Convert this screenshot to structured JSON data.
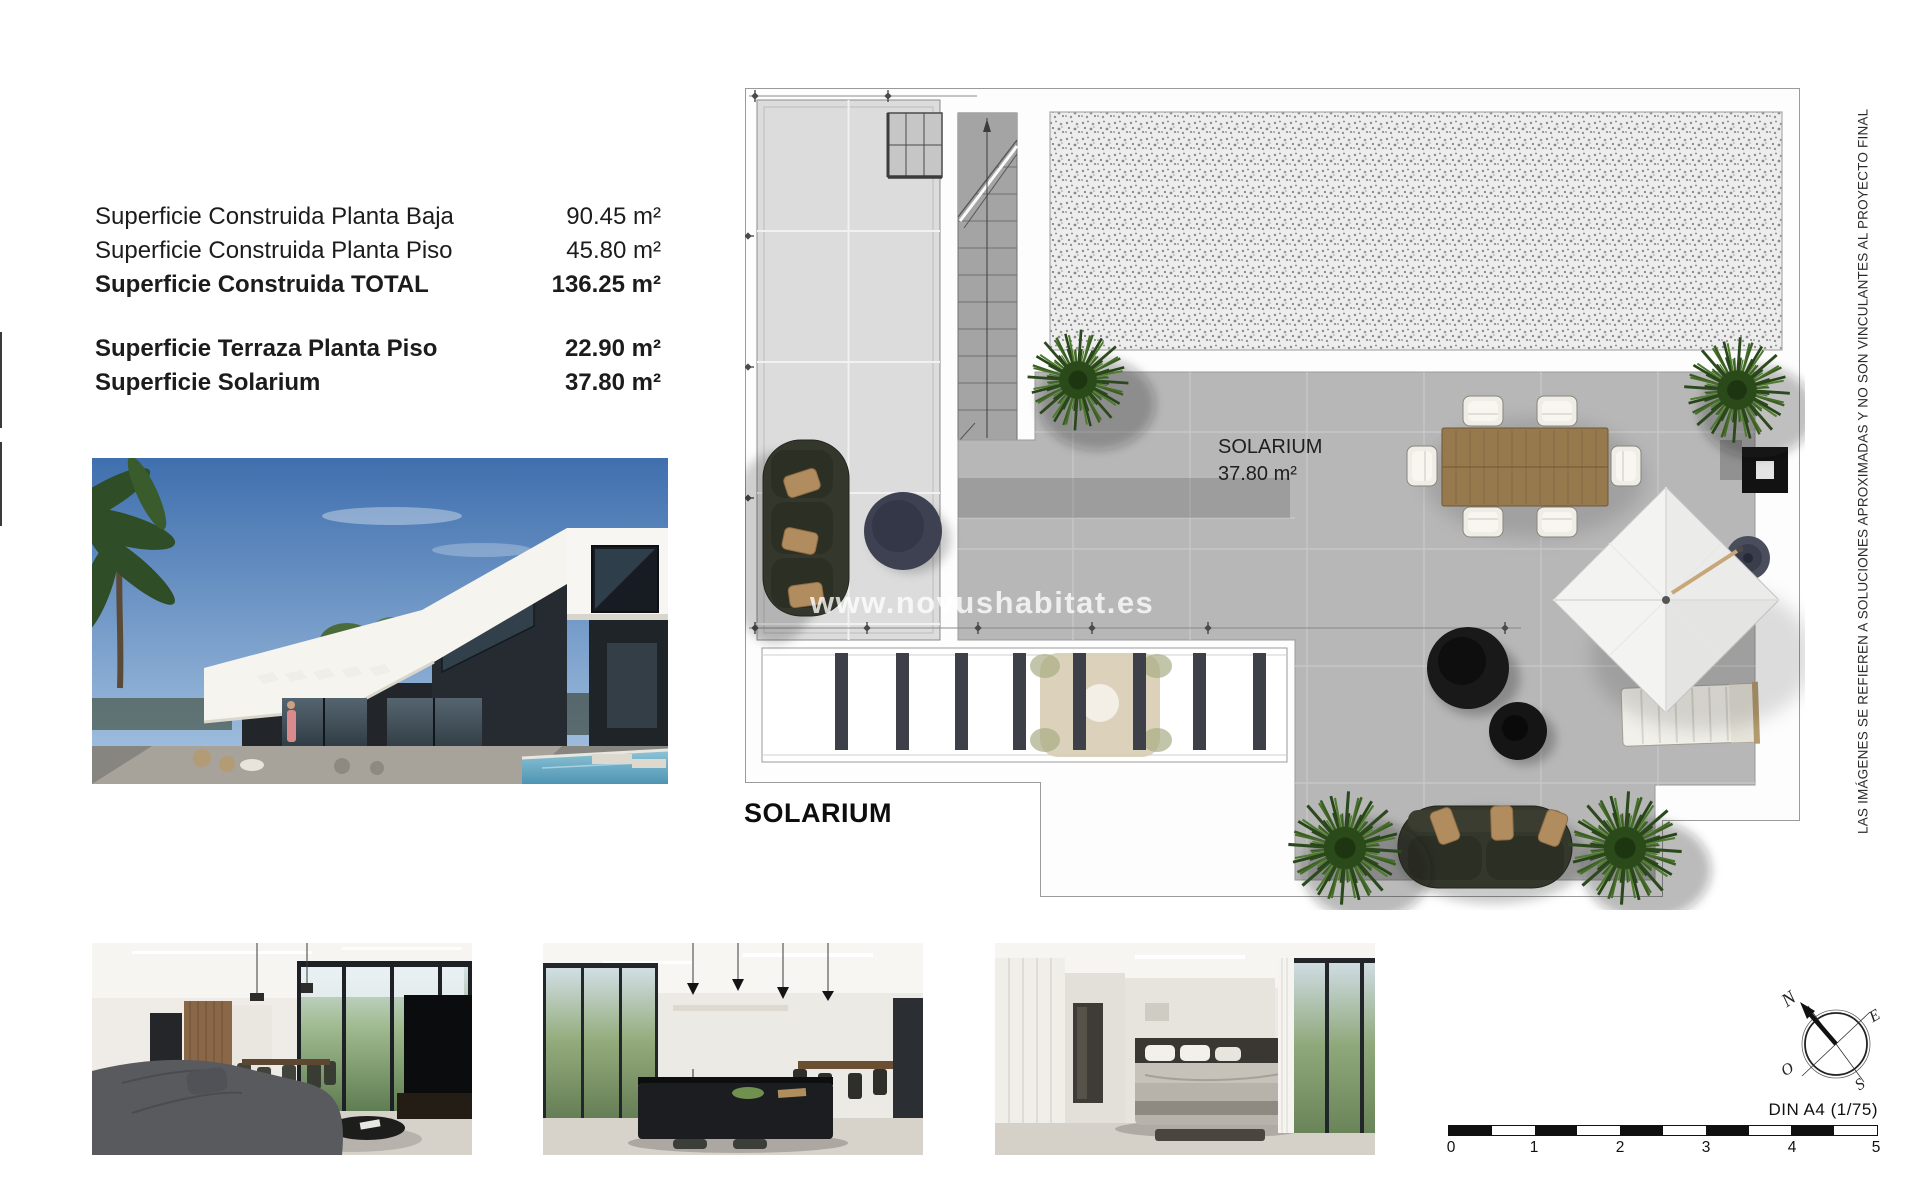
{
  "page": {
    "background": "#ffffff"
  },
  "areas": {
    "rows": [
      {
        "label": "Superficie Construida Planta Baja",
        "value": "90.45 m²"
      },
      {
        "label": "Superficie Construida Planta Piso",
        "value": "45.80 m²"
      },
      {
        "label": "Superficie Construida TOTAL",
        "value": "136.25 m²"
      },
      {
        "label": "Superficie Terraza Planta Piso",
        "value": "22.90 m²"
      },
      {
        "label": "Superficie Solarium",
        "value": "37.80 m²"
      }
    ]
  },
  "plan": {
    "heading": "SOLARIUM",
    "room_label": {
      "line1": "SOLARIUM",
      "line2": "37.80 m²"
    },
    "watermark": "www.novushabitat.es"
  },
  "disclaimer": "LAS IMÁGENES SE REFIEREN A SOLUCIONES APROXIMADAS Y NO SON VINCULANTES AL PROYECTO FINAL",
  "compass": {
    "north": "N",
    "east": "E",
    "west": "O",
    "south": "S"
  },
  "scale_bar": {
    "title": "DIN A4 (1/75)",
    "ticks": [
      "0",
      "1",
      "2",
      "3",
      "4",
      "5"
    ]
  },
  "photos": {
    "main": "villa-exterior-render",
    "bottom": [
      "living-room-render",
      "kitchen-render",
      "bedroom-render"
    ]
  },
  "colors": {
    "pavement": "#b7b7b7",
    "gravel": "#ededed",
    "plan_line": "#9a9a9a",
    "plant_green": "#2f5119",
    "sofa_olive": "#34372c",
    "watermark_white": "rgba(255,255,255,0.78)"
  }
}
